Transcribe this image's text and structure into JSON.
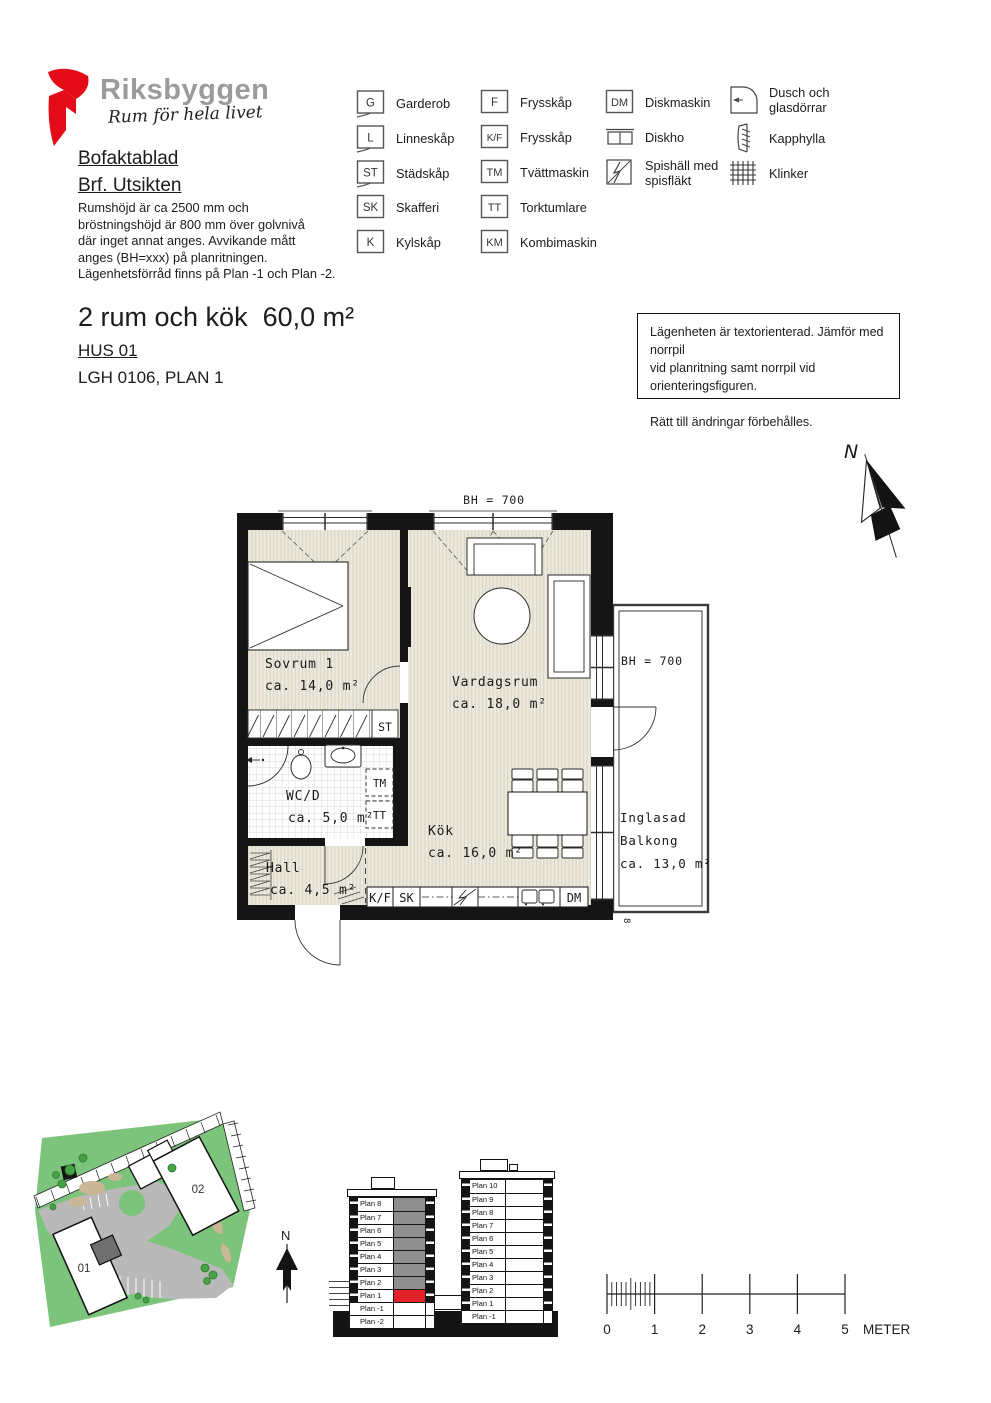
{
  "brand": {
    "name": "Riksbyggen",
    "tagline": "Rum för hela livet",
    "red": "#e30b17",
    "gray": "#9b9b9a"
  },
  "doc": {
    "title1": "Bofaktablad",
    "title2": "Brf. Utsikten",
    "description": [
      "Rumshöjd är ca 2500 mm och",
      "bröstningshöjd är 800 mm över golvnivå",
      "där inget annat anges. Avvikande mått",
      "anges (BH=xxx) på planritningen.",
      "Lägenhetsförråd finns på Plan -1 och Plan -2."
    ]
  },
  "legend": {
    "items": [
      {
        "code": "G",
        "label": "Garderob"
      },
      {
        "code": "L",
        "label": "Linneskåp"
      },
      {
        "code": "ST",
        "label": "Städskåp"
      },
      {
        "code": "SK",
        "label": "Skafferi"
      },
      {
        "code": "K",
        "label": "Kylskåp"
      },
      {
        "code": "F",
        "label": "Frysskåp"
      },
      {
        "code": "K/F",
        "label": "Frysskåp"
      },
      {
        "code": "TM",
        "label": "Tvättmaskin"
      },
      {
        "code": "TT",
        "label": "Torktumlare"
      },
      {
        "code": "KM",
        "label": "Kombimaskin"
      },
      {
        "code": "DM",
        "label": "Diskmaskin"
      },
      {
        "code": "",
        "label": "Diskho"
      },
      {
        "code": "",
        "label": "Spishäll med spisfläkt"
      },
      {
        "code": "",
        "label": "Dusch och glasdörrar"
      },
      {
        "code": "",
        "label": "Kapphylla"
      },
      {
        "code": "",
        "label": "Klinker"
      }
    ]
  },
  "apartment": {
    "title": "2 rum och kök  60,0 m²",
    "house": "HUS 01",
    "unit": "LGH 0106, PLAN 1"
  },
  "notice": {
    "line1": "Lägenheten är textorienterad. Jämför med norrpil",
    "line2": "vid planritning samt norrpil vid orienteringsfiguren.",
    "line3": "Rätt till ändringar förbehålles."
  },
  "floorplan": {
    "bh_top": "BH = 700",
    "bh_balcony": "BH = 700",
    "north_label": "N",
    "section_marker": "8",
    "rooms": {
      "sovrum": {
        "name": "Sovrum 1",
        "area": "ca. 14,0 m²"
      },
      "vardagsrum": {
        "name": "Vardagsrum",
        "area": "ca. 18,0 m²"
      },
      "wcd": {
        "name": "WC/D",
        "area": "ca. 5,0 m²"
      },
      "kok": {
        "name": "Kök",
        "area": "ca. 16,0 m²"
      },
      "hall": {
        "name": "Hall",
        "area": "ca. 4,5 m²"
      },
      "balkong": {
        "name1": "Inglasad",
        "name2": "Balkong",
        "area": "ca. 13,0 m²"
      }
    },
    "fixtures": {
      "st": "ST",
      "tm": "TM",
      "tt": "TT",
      "kf": "K/F",
      "sk": "SK",
      "dm": "DM"
    }
  },
  "site": {
    "north": "N",
    "building_01": "01",
    "building_02": "02"
  },
  "elevations": {
    "hus01": {
      "floors": [
        "Plan 8",
        "Plan 7",
        "Plan 6",
        "Plan 5",
        "Plan 4",
        "Plan 3",
        "Plan 2",
        "Plan 1",
        "Plan -1",
        "Plan -2"
      ],
      "highlight_floor": "Plan 1"
    },
    "hus02": {
      "floors": [
        "Plan 10",
        "Plan 9",
        "Plan 8",
        "Plan 7",
        "Plan 6",
        "Plan 5",
        "Plan 4",
        "Plan 3",
        "Plan 2",
        "Plan 1",
        "Plan -1"
      ]
    }
  },
  "scalebar": {
    "ticks": [
      "0",
      "1",
      "2",
      "3",
      "4",
      "5"
    ],
    "unit": "METER"
  },
  "colors": {
    "highlight_red": "#e32128",
    "elevation_gray": "#8f8f8f",
    "site_green": "#7cc47c",
    "floor_beige": "#ece9dc"
  }
}
